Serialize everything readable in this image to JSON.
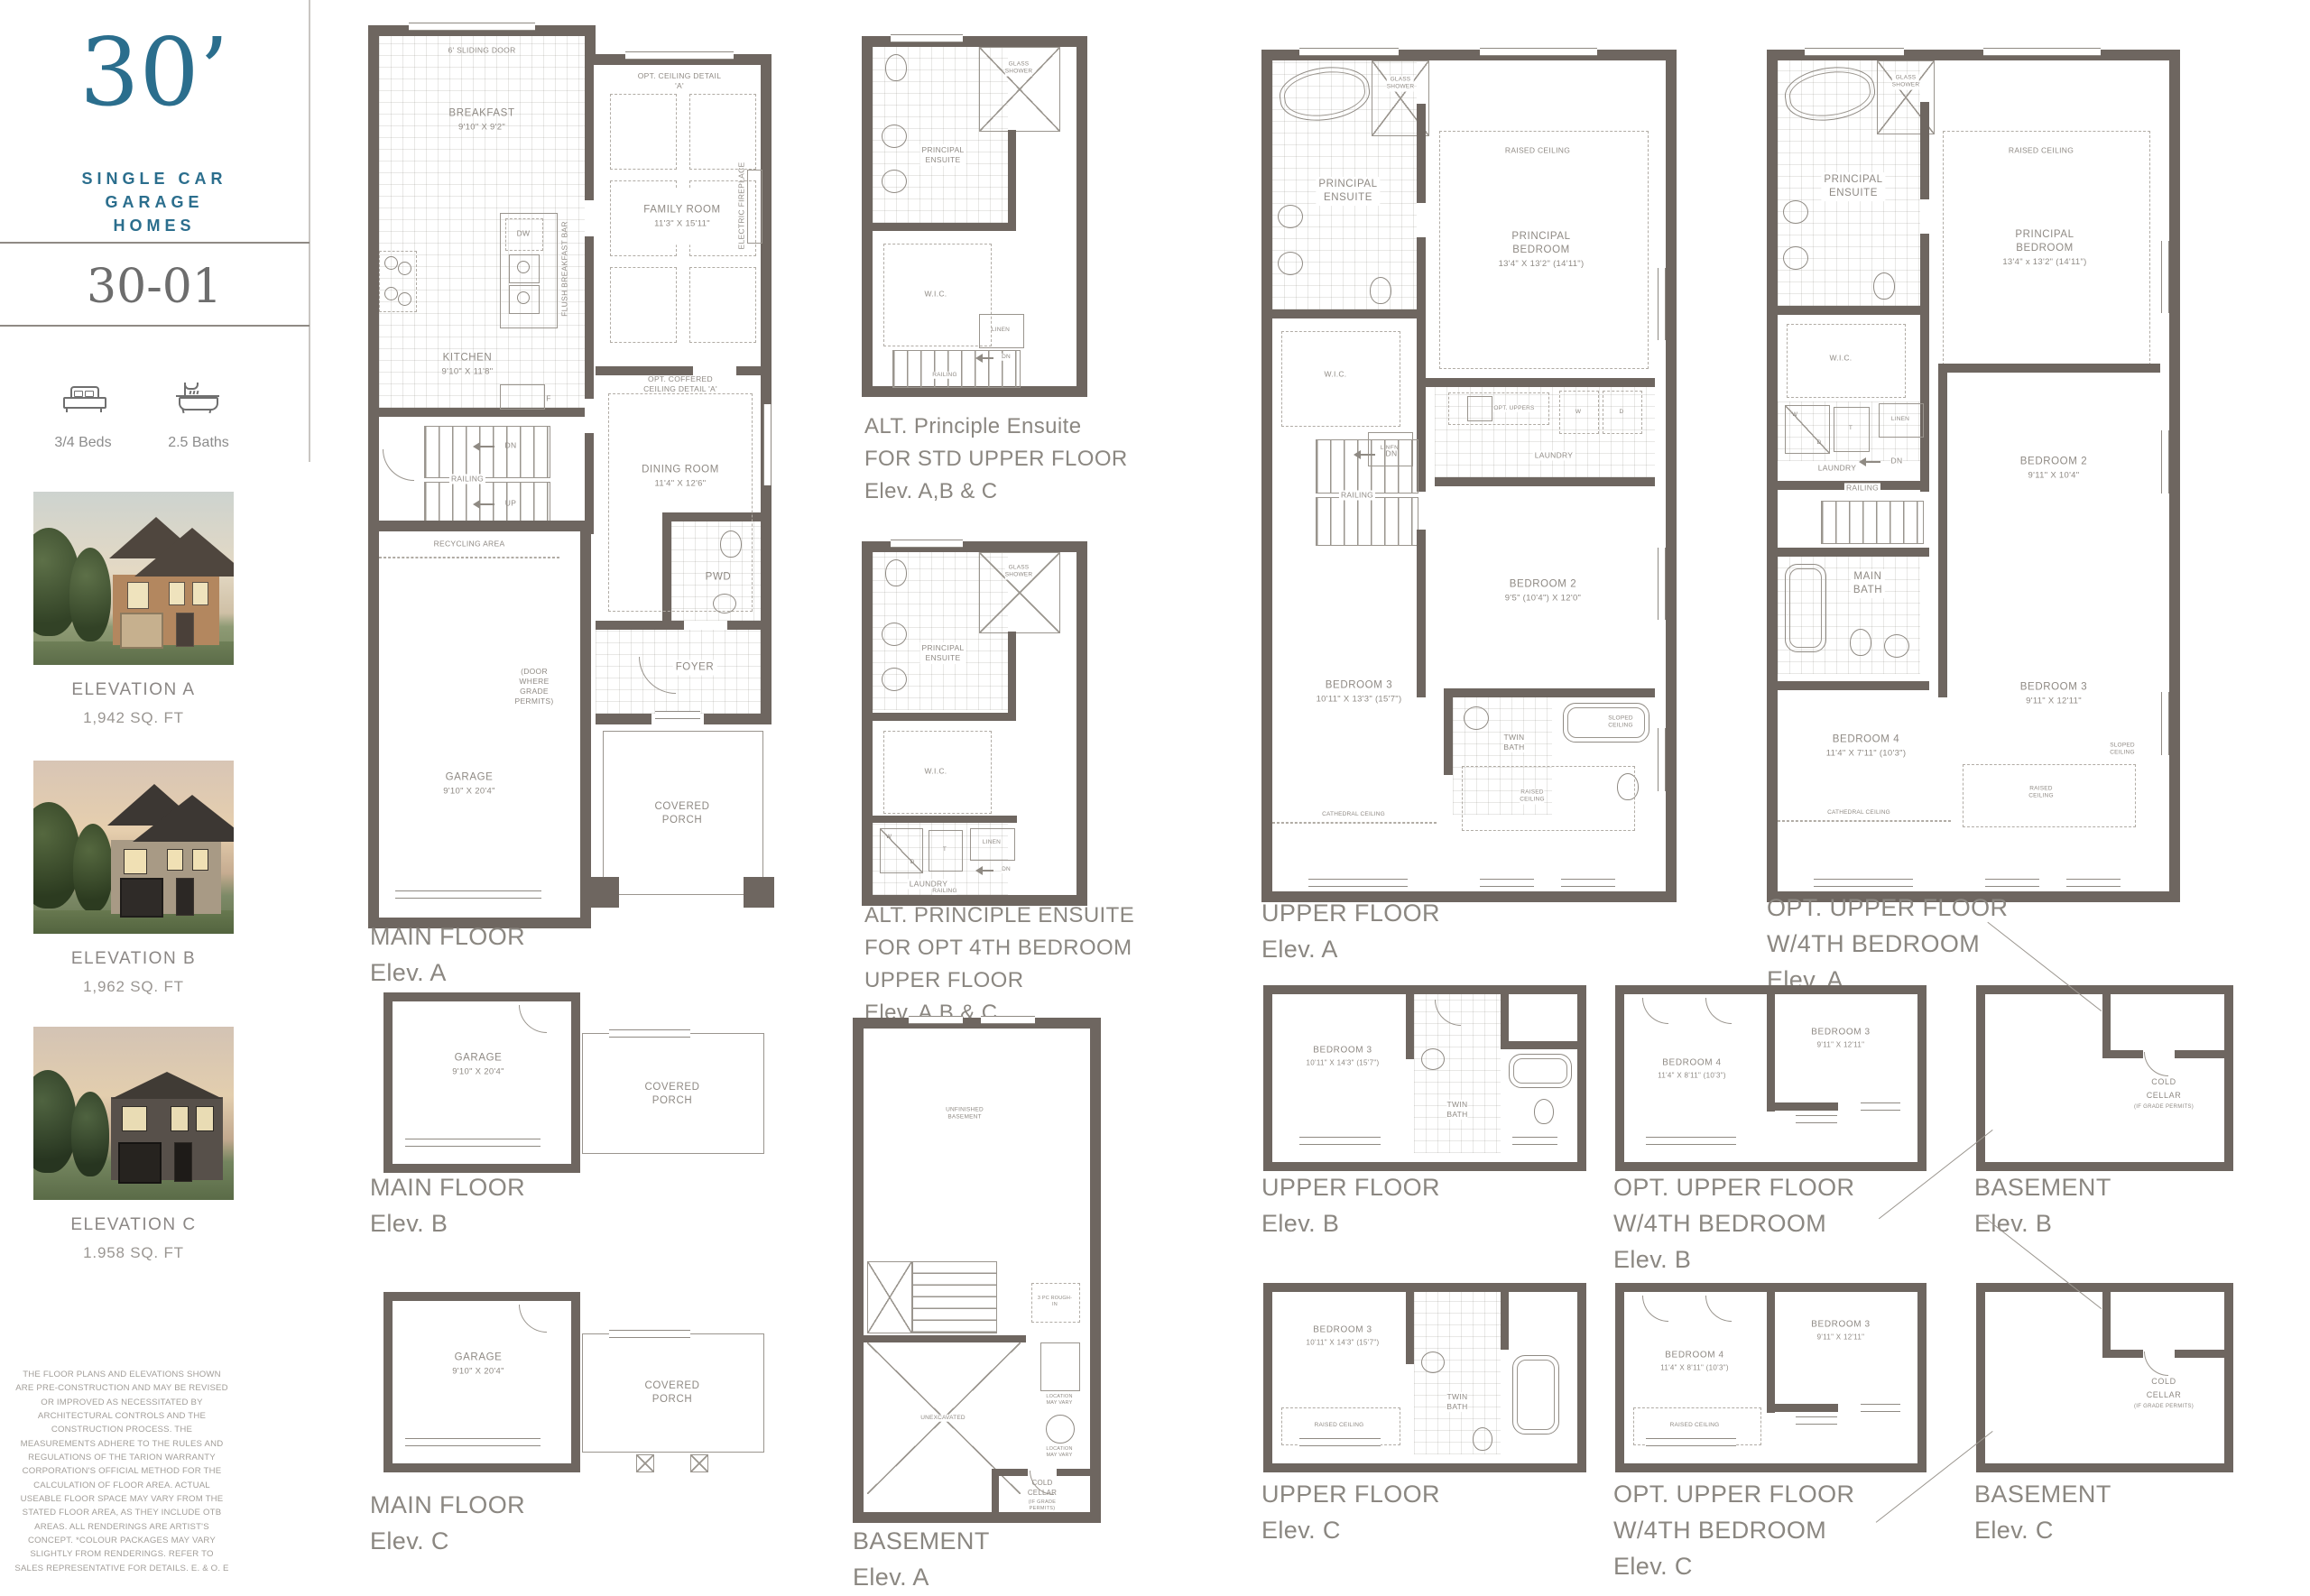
{
  "sidebar": {
    "logo_number": "30’",
    "logo_lines": [
      "SINGLE CAR",
      "GARAGE",
      "HOMES"
    ],
    "model": "30-01",
    "beds_label": "3/4 Beds",
    "baths_label": "2.5 Baths",
    "elevations": [
      {
        "name": "ELEVATION A",
        "sqft": "1,942 SQ. FT"
      },
      {
        "name": "ELEVATION B",
        "sqft": "1,962 SQ. FT"
      },
      {
        "name": "ELEVATION C",
        "sqft": "1.958 SQ. FT"
      }
    ],
    "disclaimer": "THE FLOOR PLANS AND ELEVATIONS SHOWN ARE PRE-CONSTRUCTION AND MAY BE REVISED OR IMPROVED AS NECESSITATED BY ARCHITECTURAL CONTROLS AND THE CONSTRUCTION PROCESS. THE MEASUREMENTS ADHERE TO THE RULES AND REGULATIONS OF THE TARION WARRANTY CORPORATION'S OFFICIAL METHOD FOR THE CALCULATION OF FLOOR AREA. ACTUAL USEABLE FLOOR SPACE MAY VARY FROM THE STATED FLOOR AREA, AS THEY INCLUDE OTB AREAS. ALL RENDERINGS ARE ARTIST'S CONCEPT. *COLOUR PACKAGES MAY VARY SLIGHTLY FROM RENDERINGS. REFER TO SALES REPRESENTATIVE FOR DETAILS. E. & O. E"
  },
  "plans": {
    "main_a": {
      "caption": [
        "MAIN FLOOR",
        "Elev. A"
      ],
      "sliding_door": "6' SLIDING DOOR",
      "breakfast": "BREAKFAST",
      "breakfast_dim": "9'10\" X 9'2\"",
      "opt_ceiling": "OPT. CEILING DETAIL 'A'",
      "family_room": "FAMILY ROOM",
      "family_room_dim": "11'3\" X 15'11\"",
      "electric_fireplace": "ELECTRIC FIREPLACE",
      "dw": "DW",
      "flush_bar": "FLUSH BREAKFAST BAR",
      "fridge": "F",
      "kitchen": "KITCHEN",
      "kitchen_dim": "9'10\" X 11'8\"",
      "opt_coffered": "OPT. COFFERED CEILING DETAIL 'A'",
      "dining_room": "DINING ROOM",
      "dining_room_dim": "11'4\" X 12'6\"",
      "dn": "DN",
      "up": "UP",
      "railing": "RAILING",
      "recycling": "RECYCLING AREA",
      "door_note": "(DOOR\nWHERE\nGRADE\nPERMITS)",
      "pwd": "PWD",
      "garage": "GARAGE",
      "garage_dim": "9'10\" X 20'4\"",
      "foyer": "FOYER",
      "covered_porch": "COVERED\nPORCH"
    },
    "alt_std": {
      "caption": [
        "ALT. Principle Ensuite",
        "FOR STD UPPER FLOOR",
        "Elev. A,B & C"
      ],
      "glass_shower": "GLASS\nSHOWER",
      "principal_ensuite": "PRINCIPAL\nENSUITE",
      "wic": "W.I.C.",
      "linen": "LINEN",
      "dn": "DN",
      "railing": "RAILING"
    },
    "alt_4th": {
      "caption": [
        "ALT. PRINCIPLE ENSUITE",
        "FOR OPT 4TH BEDROOM",
        "UPPER FLOOR",
        "Elev. A,B & C"
      ],
      "glass_shower": "GLASS\nSHOWER",
      "principal_ensuite": "PRINCIPAL\nENSUITE",
      "wic": "W.I.C.",
      "w": "W",
      "d": "D",
      "t": "T",
      "linen": "LINEN",
      "laundry": "LAUNDRY",
      "dn": "DN",
      "railing": "RAILING"
    },
    "upper_a": {
      "caption": [
        "UPPER FLOOR",
        "Elev. A"
      ],
      "glass_shower": "GLASS\nSHOWER",
      "principal_ensuite": "PRINCIPAL\nENSUITE",
      "raised_ceiling": "RAISED CEILING",
      "principal_bedroom": "PRINCIPAL BEDROOM",
      "principal_bedroom_dim": "13'4\" X 13'2\" (14'11\")",
      "wic": "W.I.C.",
      "linen": "LINEN",
      "opt_uppers": "OPT. UPPERS",
      "w": "W",
      "d": "D",
      "laundry": "LAUNDRY",
      "dn": "DN",
      "railing": "RAILING",
      "bedroom2": "BEDROOM 2",
      "bedroom2_dim": "9'5\" (10'4\") X 12'0\"",
      "bedroom3": "BEDROOM 3",
      "bedroom3_dim": "10'11\" X 13'3\" (15'7\")",
      "twin_bath": "TWIN\nBATH",
      "sloped_ceiling": "SLOPED\nCEILING",
      "raised_ceiling2": "RAISED\nCEILING",
      "cathedral_ceiling": "CATHEDRAL CEILING"
    },
    "opt_upper_a": {
      "caption": [
        "OPT. UPPER FLOOR",
        "W/4TH BEDROOM",
        "Elev. A"
      ],
      "glass_shower": "GLASS\nSHOWER",
      "principal_ensuite": "PRINCIPAL\nENSUITE",
      "raised_ceiling": "RAISED CEILING",
      "principal_bedroom": "PRINCIPAL BEDROOM",
      "principal_bedroom_dim": "13'4\" x 13'2\" (14'11\")",
      "wic": "W.I.C.",
      "w": "W",
      "d": "D",
      "t": "T",
      "linen": "LINEN",
      "laundry": "LAUNDRY",
      "dn": "DN",
      "railing": "RAILING",
      "bedroom2": "BEDROOM 2",
      "bedroom2_dim": "9'11\" X 10'4\"",
      "main_bath": "MAIN\nBATH",
      "bedroom3": "BEDROOM 3",
      "bedroom3_dim": "9'11\" X 12'11\"",
      "bedroom4": "BEDROOM 4",
      "bedroom4_dim": "11'4\" X 7'11\" (10'3\")",
      "cathedral_ceiling": "CATHEDRAL CEILING",
      "raised_ceiling2": "RAISED\nCEILING",
      "sloped_ceiling": "SLOPED\nCEILING"
    },
    "basement_a": {
      "caption": [
        "BASEMENT",
        "Elev. A"
      ],
      "unfinished": "UNFINISHED\nBASEMENT",
      "unexcavated": "UNEXCAVATED",
      "rough_in": "3 PC ROUGH-IN",
      "location_note1": "LOCATION\nMAY VARY",
      "location_note2": "LOCATION\nMAY VARY",
      "cold_cellar": "COLD CELLAR",
      "cold_cellar_sub": "(IF GRADE PERMITS)"
    },
    "main_b": {
      "caption": [
        "MAIN FLOOR",
        "Elev. B"
      ],
      "garage": "GARAGE",
      "garage_dim": "9'10\" X 20'4\"",
      "covered_porch": "COVERED\nPORCH"
    },
    "main_c": {
      "caption": [
        "MAIN FLOOR",
        "Elev. C"
      ],
      "garage": "GARAGE",
      "garage_dim": "9'10\" X 20'4\"",
      "covered_porch": "COVERED\nPORCH"
    },
    "upper_b": {
      "caption": [
        "UPPER FLOOR",
        "Elev. B"
      ],
      "bedroom3": "BEDROOM 3",
      "bedroom3_dim": "10'11\" X 14'3\" (15'7\")",
      "twin_bath": "TWIN\nBATH"
    },
    "opt_upper_b": {
      "caption": [
        "OPT. UPPER FLOOR",
        "W/4TH BEDROOM",
        "Elev. B"
      ],
      "bedroom4": "BEDROOM 4",
      "bedroom4_dim": "11'4\" X 8'11\" (10'3\")",
      "bedroom3": "BEDROOM 3",
      "bedroom3_dim": "9'11\" X 12'11\""
    },
    "basement_b": {
      "caption": [
        "BASEMENT",
        "Elev. B"
      ],
      "cold_cellar": "COLD CELLAR",
      "cold_cellar_sub": "(IF GRADE PERMITS)"
    },
    "upper_c": {
      "caption": [
        "UPPER FLOOR",
        "Elev. C"
      ],
      "bedroom3": "BEDROOM 3",
      "bedroom3_dim": "10'11\" X 14'3\" (15'7\")",
      "twin_bath": "TWIN\nBATH",
      "raised_ceiling": "RAISED CEILING"
    },
    "opt_upper_c": {
      "caption": [
        "OPT. UPPER FLOOR",
        "W/4TH BEDROOM",
        "Elev. C"
      ],
      "bedroom4": "BEDROOM 4",
      "bedroom4_dim": "11'4\" X 8'11\" (10'3\")",
      "raised_ceiling": "RAISED CEILING",
      "bedroom3": "BEDROOM 3",
      "bedroom3_dim": "9'11\" X 12'11\""
    },
    "basement_c": {
      "caption": [
        "BASEMENT",
        "Elev. C"
      ],
      "cold_cellar": "COLD CELLAR",
      "cold_cellar_sub": "(IF GRADE PERMITS)"
    }
  },
  "colors": {
    "accent_teal": "#2b6e8d",
    "wall": "#6e6660",
    "label_gray": "#8f8a84"
  }
}
